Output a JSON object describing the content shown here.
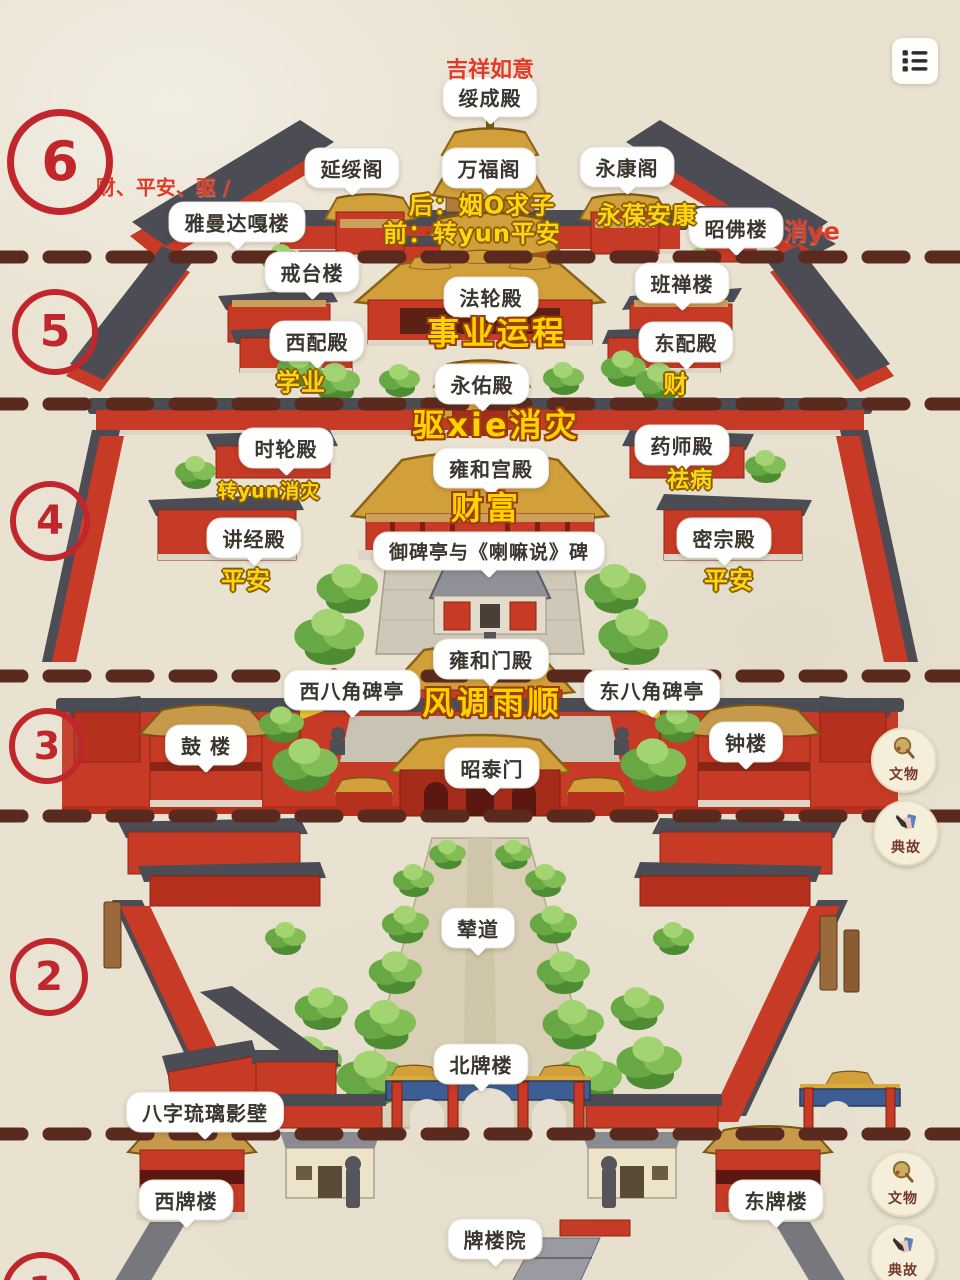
{
  "colors": {
    "paper": "#e9e2d1",
    "accent_red": "#c0272d",
    "annotation_red": "#e23b25",
    "annotation_yellow": "#ffd512",
    "dash_brown": "#5b2a1e",
    "wall_red": "#c63a26",
    "roof_dark": "#4b4c54",
    "roof_gold": "#d2a03a",
    "paifang_blue": "#3d5e94",
    "tree_green": "#68a844"
  },
  "menu_button": {
    "icon": "list-icon"
  },
  "section_markers": [
    {
      "n": "6",
      "x": 60,
      "y": 162,
      "r": 46,
      "bw": 7,
      "fs": 54
    },
    {
      "n": "5",
      "x": 55,
      "y": 332,
      "r": 37,
      "bw": 6,
      "fs": 44
    },
    {
      "n": "4",
      "x": 50,
      "y": 521,
      "r": 34,
      "bw": 6,
      "fs": 40
    },
    {
      "n": "3",
      "x": 47,
      "y": 746,
      "r": 32,
      "bw": 6,
      "fs": 38
    },
    {
      "n": "2",
      "x": 49,
      "y": 977,
      "r": 33,
      "bw": 6,
      "fs": 40
    },
    {
      "n": "1",
      "x": 42,
      "y": 1292,
      "r": 34,
      "bw": 6,
      "fs": 40
    }
  ],
  "dividers": [
    {
      "y": 257
    },
    {
      "y": 404
    },
    {
      "y": 676
    },
    {
      "y": 816
    },
    {
      "y": 1134
    }
  ],
  "bubbles": [
    {
      "text": "绥成殿",
      "x": 490,
      "y": 97
    },
    {
      "text": "延绥阁",
      "x": 352,
      "y": 168
    },
    {
      "text": "万福阁",
      "x": 489,
      "y": 168
    },
    {
      "text": "永康阁",
      "x": 627,
      "y": 167
    },
    {
      "text": "雅曼达嘎楼",
      "x": 237,
      "y": 222
    },
    {
      "text": "昭佛楼",
      "x": 736,
      "y": 228
    },
    {
      "text": "戒台楼",
      "x": 312,
      "y": 272
    },
    {
      "text": "班禅楼",
      "x": 682,
      "y": 283
    },
    {
      "text": "法轮殿",
      "x": 491,
      "y": 297
    },
    {
      "text": "西配殿",
      "x": 317,
      "y": 341
    },
    {
      "text": "东配殿",
      "x": 686,
      "y": 342
    },
    {
      "text": "永佑殿",
      "x": 482,
      "y": 384
    },
    {
      "text": "时轮殿",
      "x": 286,
      "y": 448
    },
    {
      "text": "药师殿",
      "x": 682,
      "y": 445
    },
    {
      "text": "雍和宫殿",
      "x": 491,
      "y": 468
    },
    {
      "text": "讲经殿",
      "x": 254,
      "y": 538
    },
    {
      "text": "密宗殿",
      "x": 724,
      "y": 538
    },
    {
      "text": "御碑亭与《喇嘛说》碑",
      "x": 489,
      "y": 551,
      "fs": 19
    },
    {
      "text": "雍和门殿",
      "x": 491,
      "y": 659
    },
    {
      "text": "西八角碑亭",
      "x": 352,
      "y": 690
    },
    {
      "text": "东八角碑亭",
      "x": 652,
      "y": 690
    },
    {
      "text": "鼓 楼",
      "x": 206,
      "y": 745
    },
    {
      "text": "钟楼",
      "x": 746,
      "y": 742
    },
    {
      "text": "昭泰门",
      "x": 492,
      "y": 768
    },
    {
      "text": "辇道",
      "x": 478,
      "y": 928
    },
    {
      "text": "北牌楼",
      "x": 481,
      "y": 1064
    },
    {
      "text": "八字琉璃影壁",
      "x": 205,
      "y": 1112
    },
    {
      "text": "西牌楼",
      "x": 186,
      "y": 1200
    },
    {
      "text": "东牌楼",
      "x": 776,
      "y": 1200
    },
    {
      "text": "牌楼院",
      "x": 495,
      "y": 1239
    }
  ],
  "keywords": [
    {
      "text": "吉祥如意",
      "x": 490,
      "y": 68,
      "style": "red",
      "fs": 22
    },
    {
      "text": "财、平安、驱 /",
      "x": 163,
      "y": 186,
      "style": "red",
      "fs": 20
    },
    {
      "text": "消ye",
      "x": 812,
      "y": 229,
      "style": "red",
      "fs": 24
    },
    {
      "text": "后：姻O求子",
      "x": 482,
      "y": 203,
      "style": "yellow",
      "fs": 24
    },
    {
      "text": "前：转yun平安",
      "x": 472,
      "y": 231,
      "style": "yellow",
      "fs": 24
    },
    {
      "text": "永葆安康",
      "x": 647,
      "y": 213,
      "style": "yellow",
      "fs": 24
    },
    {
      "text": "事业运程",
      "x": 497,
      "y": 331,
      "style": "yellowbig",
      "fs": 32
    },
    {
      "text": "学业",
      "x": 301,
      "y": 380,
      "style": "yellow",
      "fs": 24
    },
    {
      "text": "财",
      "x": 676,
      "y": 382,
      "style": "yellow",
      "fs": 24
    },
    {
      "text": "驱xie消灾",
      "x": 496,
      "y": 423,
      "style": "yellowbig",
      "fs": 32
    },
    {
      "text": "转yun消灾",
      "x": 269,
      "y": 490,
      "style": "yellow",
      "fs": 19
    },
    {
      "text": "祛病",
      "x": 690,
      "y": 478,
      "style": "yellow",
      "fs": 22
    },
    {
      "text": "财富",
      "x": 486,
      "y": 506,
      "style": "yellowbig",
      "fs": 32
    },
    {
      "text": "平安",
      "x": 246,
      "y": 578,
      "style": "yellow",
      "fs": 24
    },
    {
      "text": "平安",
      "x": 729,
      "y": 578,
      "style": "yellow",
      "fs": 24
    },
    {
      "text": "风调雨顺",
      "x": 492,
      "y": 701,
      "style": "yellowbig",
      "fs": 32
    }
  ],
  "badges": [
    {
      "label": "文物",
      "icon": "mirror-icon",
      "x": 904,
      "y": 760
    },
    {
      "label": "典故",
      "icon": "brush-icon",
      "x": 906,
      "y": 833
    },
    {
      "label": "文物",
      "icon": "mirror-icon",
      "x": 903,
      "y": 1184
    },
    {
      "label": "典故",
      "icon": "brush-icon",
      "x": 903,
      "y": 1256
    }
  ]
}
